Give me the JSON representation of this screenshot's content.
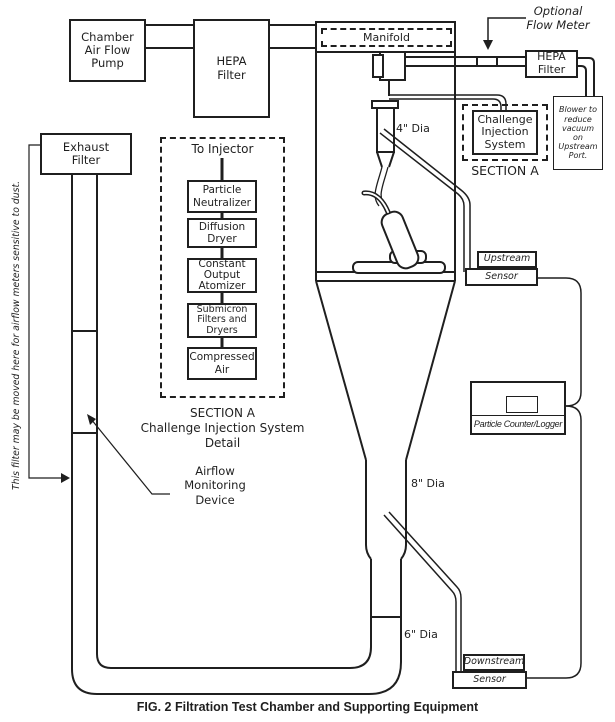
{
  "caption": "FIG. 2 Filtration Test Chamber and Supporting Equipment",
  "top": {
    "pump_label": "Chamber\nAir Flow\nPump",
    "hepa_left_label": "HEPA\nFilter",
    "manifold_label": "Manifold",
    "optional_flow_meter_label": "Optional\nFlow Meter",
    "hepa_right_label": "HEPA\nFilter",
    "blower_note": "Blower to\nreduce\nvacuum\non\nUpstream\nPort."
  },
  "challenge": {
    "box_label": "Challenge\nInjection\nSystem",
    "section_label": "SECTION A"
  },
  "exhaust": {
    "filter_label": "Exhaust\nFilter",
    "moved_note": "This filter may be moved here for airflow meters sensitive to dust."
  },
  "injector_detail": {
    "to_injector": "To Injector",
    "items": [
      "Particle\nNeutralizer",
      "Diffusion\nDryer",
      "Constant\nOutput\nAtomizer",
      "Submicron\nFilters and\nDryers",
      "Compressed\nAir"
    ],
    "caption": "SECTION A\nChallenge Injection System\nDetail"
  },
  "labels": {
    "dia4": "4\" Dia",
    "dia8": "8\" Dia",
    "dia6": "6\" Dia",
    "airflow_device": "Airflow\nMonitoring\nDevice"
  },
  "sensors": {
    "upstream_top": "Upstream",
    "upstream_bottom": "Sensor",
    "downstream_top": "Downstream",
    "downstream_bottom": "Sensor",
    "particle_counter": "Particle Counter/Logger"
  },
  "colors": {
    "line": "#1f1f1f",
    "background": "#ffffff"
  }
}
